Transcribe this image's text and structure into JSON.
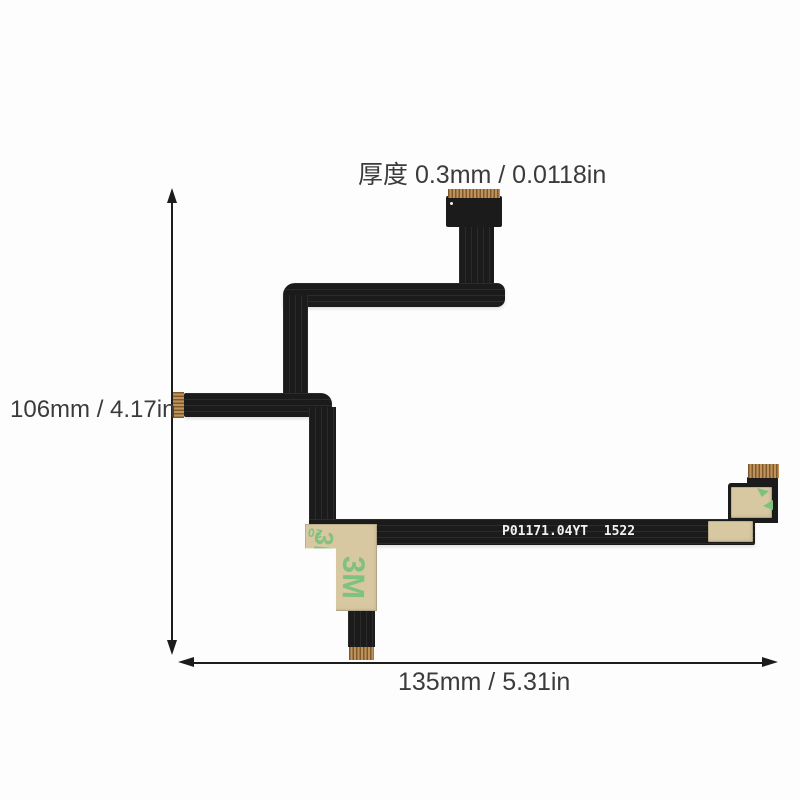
{
  "labels": {
    "thickness": "厚度 0.3mm / 0.0118in",
    "height": "106mm / 4.17in",
    "width": "135mm / 5.31in"
  },
  "cable": {
    "part_number": "P01171.04YT  1522",
    "sticker_brand": "3M",
    "sticker_code": "20"
  },
  "colors": {
    "background": "#fdfdfd",
    "cable_black": "#1b1b1b",
    "gold": "#c1925a",
    "gold_dark": "#7d5a2e",
    "sticker_beige": "#d8c8a2",
    "sticker_green": "#7fc17f",
    "dimension_ink": "#1c1c1c",
    "label_ink": "#3b3b3b",
    "cable_text": "#f2f2f2"
  }
}
